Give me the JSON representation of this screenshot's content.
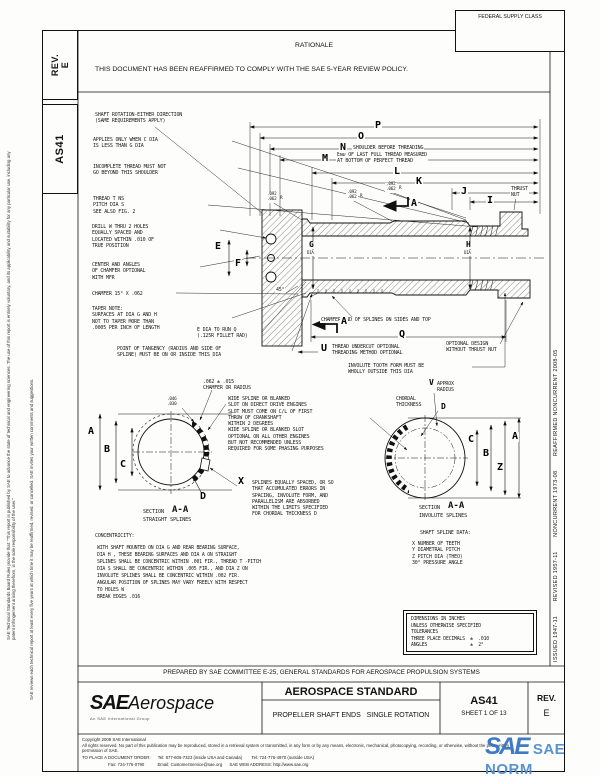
{
  "margin": {
    "col1": "SAE Technical Standards Board Rules provide that: \"This report is published by SAE to advance the state of technical and engineering sciences. The use of this report is entirely voluntary, and its applicability and suitability for any particular use, including any patent infringement arising therefrom, is the sole responsibility of the user.\"",
    "col2": "SAE reviews each technical report at least every five years at which time it may be reaffirmed, revised, or cancelled. SAE invites your written comments and suggestions."
  },
  "header": {
    "rev_box": "REV.\nE",
    "doc_code": "AS41",
    "federal_supply_class": "FEDERAL SUPPLY CLASS",
    "rationale_title": "RATIONALE",
    "rationale_body": "THIS DOCUMENT HAS BEEN REAFFIRMED TO COMPLY WITH THE SAE 5-YEAR REVIEW POLICY."
  },
  "sidebar": {
    "history": "ISSUED 1947-11        REVISED 1957-11        NONCURRENT 1973-08        REAFFIRMED NONCURRENT 2008-05"
  },
  "letters": {
    "P": "P",
    "O": "O",
    "N": "N",
    "M": "M",
    "L": "L",
    "K": "K",
    "J": "J",
    "I": "I",
    "Q": "Q",
    "U": "U",
    "E": "E",
    "F": "F",
    "G": "G",
    "H": "H",
    "R": "R",
    "A": "A",
    "B": "B",
    "C": "C",
    "D": "D",
    "V": "V",
    "X": "X",
    "Z": "Z"
  },
  "dims": {
    "d092": ".092\n.062",
    "d046": ".046\n.030",
    "d45": "45°",
    "chamfer062": ".062 ± .015\nCHAMFER OR RADIUS",
    "dia": "DIA"
  },
  "notes": {
    "shaft_rotation": "SHAFT ROTATION-EITHER DIRECTION\n(SAME REQUIREMENTS APPLY)",
    "applies_only": "APPLIES ONLY WHEN C DIA\nIS LESS THAN G DIA",
    "incomplete_thread": "INCOMPLETE THREAD MUST NOT\nGO BEYOND THIS SHOULDER",
    "thread_t": "THREAD T NS\nPITCH DIA S\nSEE ALSO FIG. 2",
    "drill_w": "DRILL W THRU 2 HOLES\nEQUALLY SPACED AND\nLOCATED WITHIN .010 OF\nTRUE POSITION",
    "center_angles": "CENTER AND ANGLES\nOF CHAMFER OPTIONAL\nWITH MFR",
    "chamfer15": "CHAMFER 15° X .062",
    "taper_note": "TAPER NOTE:\nSURFACES AT DIA G AND H\nNOT TO TAPER MORE THAN\n.0005 PER INCH OF LENGTH",
    "e_dia": "E DIA TO RUN Q\n(.125R FILLET RAD)",
    "tangency": "POINT OF TANGENCY (RADIUS AND SIDE OF\nSPLINE) MUST BE ON OR INSIDE THIS DIA",
    "shoulder": "SHOULDER BEFORE THREADING",
    "last_thread": "END OF LAST FULL THREAD MEASURED\nAT BOTTOM OF PERFECT THREAD",
    "thrust_nut": "THRUST\nNUT",
    "chamfer_end": "CHAMFER END OF SPLINES ON SIDES AND TOP",
    "u_note": "THREAD UNDERCUT OPTIONAL\nTHREADING METHOD OPTIONAL",
    "optional_design": "OPTIONAL DESIGN\nWITHOUT THRUST NUT",
    "involute_tooth": "INVOLUTE TOOTH FORM MUST BE\nWHOLLY OUTSIDE THIS DIA",
    "wide_spline": "WIDE SPLINE OR BLANKED\nSLOT ON DIRECT DRIVE ENGINES\nSLOT MUST COME ON C/L OF FIRST\nTHROW OF CRANKSHAFT\nWITHIN 2 DEGREES\nWIDE SPLINE OR BLANKED SLOT\nOPTIONAL ON ALL OTHER ENGINES\nBUT NOT RECOMMENDED UNLESS\nREQUIRED FOR SOME PHASING PURPOSES",
    "x_note": "SPLINES EQUALLY SPACED, OR SO\nTHAT ACCUMULATED ERRORS IN\nSPACING, INVOLUTE FORM, AND\nPARALLELISM ARE ABSORBED\nWITHIN THE LIMITS SPECIFIED\nFOR CHORDAL THICKNESS  D",
    "v_note": "APPROX\nRADIUS",
    "chordal": "CHORDAL\nTHICKNESS"
  },
  "sections": {
    "section_word": "SECTION",
    "aa": "A-A",
    "left_type": "STRAIGHT SPLINES",
    "right_type": "INVOLUTE SPLINES",
    "spline_data_title": "SHAFT SPLINE DATA:",
    "spline_data_items": "X NUMBER OF TEETH\nY DIAMETRAL PITCH\nZ PITCH DIA (THEO)\n  30° PRESSURE ANGLE"
  },
  "concentricity": {
    "title": "CONCENTRICITY:",
    "body": "WITH SHAFT MOUNTED ON DIA G AND REAR BEARING SURFACE,\nDIA H , THESE BEARING SURFACES AND DIA A ON STRAIGHT\nSPLINES SHALL BE CONCENTRIC WITHIN .001 FIR., THREAD T -PITCH\nDIA S SHALL BE CONCENTRIC WITHIN .005 FIR., AND DIA Z ON\nINVOLUTE SPLINES SHALL BE CONCENTRIC WITHIN .002 FIR.\nANGULAR POSITION OF SPLINES MAY VARY FREELY WITH RESPECT\nTO HOLES W\nBREAK EDGES .016"
  },
  "tolerance_box": "DIMENSIONS IN INCHES\nUNLESS OTHERWISE SPECIFIED\nTOLERANCES\nTHREE PLACE DECIMALS  ±  .010\nANGLES                ±  2°",
  "footer": {
    "prepared_by": "PREPARED BY SAE COMMITTEE E-25, GENERAL STANDARDS FOR AEROSPACE PROPULSION SYSTEMS",
    "logo_main": "SAE",
    "logo_sub": "Aerospace",
    "logo_tag": "An SAE International Group",
    "doc_type": "AEROSPACE STANDARD",
    "doc_title": "PROPELLER SHAFT ENDS   SINGLE ROTATION",
    "doc_number": "AS41",
    "sheet": "SHEET 1 OF 13",
    "rev_label": "REV.",
    "rev_value": "E",
    "copyright": "Copyright 2008 SAE International",
    "rights": "All rights reserved. No part of this publication may be reproduced, stored in a retrieval system or transmitted, in any form or by any means, electronic, mechanical, photocopying, recording, or otherwise, without the prior written permission of SAE.",
    "order_line1": "TO PLACE A DOCUMENT ORDER:      Tel: 877-606-7323 (inside USA and Canada)        Tel: 724-776-4970 (outside USA)",
    "order_line2": "Fax: 724-776-0790           Email: CustomerService@sae.org      SAE WEB ADDRESS: http://www.sae.org"
  },
  "watermark": {
    "logo": "SAE",
    "text": "SAE NORM"
  }
}
